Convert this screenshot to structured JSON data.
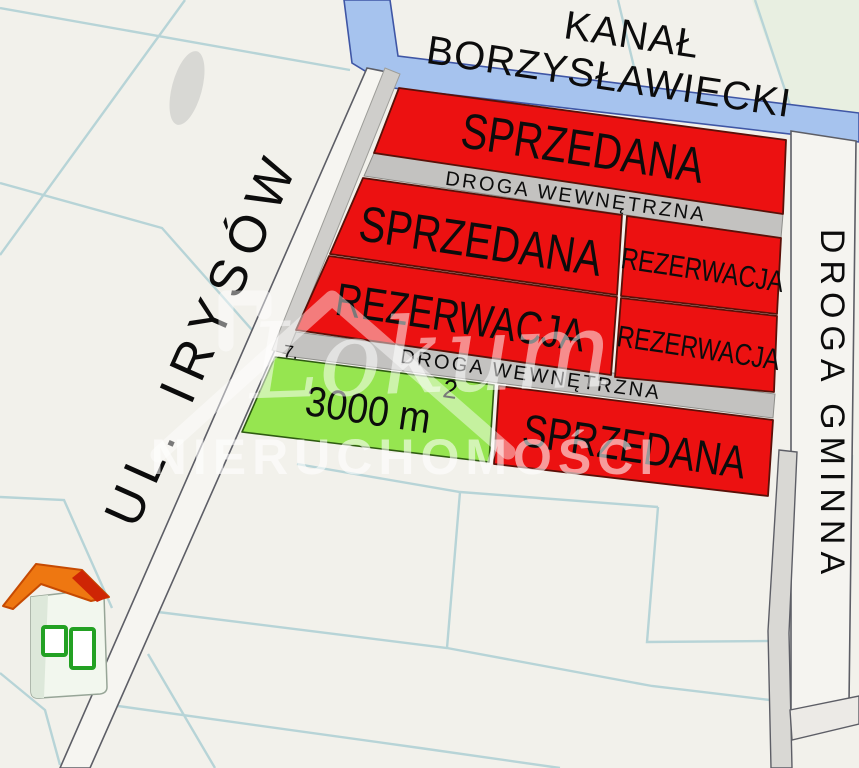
{
  "canal": {
    "line1": "KANAŁ",
    "line2": "BORZYSŁAWIECKI"
  },
  "streets": {
    "left_road": "UL. IRYSÓW",
    "right_road": "DROGA GMINNA",
    "internal_road_top": "DROGA WEWNĘTRZNA",
    "internal_road_bottom": "DROGA WEWNĘTRZNA"
  },
  "plots": {
    "row1": {
      "status": "SPRZEDANA"
    },
    "row2_left": {
      "status": "SPRZEDANA"
    },
    "row2_right": {
      "status": "REZERWACJA"
    },
    "row3_left": {
      "status": "REZERWACJA"
    },
    "row3_right": {
      "status": "REZERWACJA"
    },
    "row4_right": {
      "status": "SPRZEDANA"
    },
    "offered": {
      "number": "7.",
      "area": "3000 m",
      "area_exponent": "2"
    }
  },
  "watermark": {
    "brand_script": "Lokum",
    "brand_caps": "NIERUCHOMOŚCI"
  },
  "colors": {
    "background": "#f2f1eb",
    "field_green": "#e8efe1",
    "sold_reserved_red": "#ec1111",
    "offered_green": "#96e550",
    "internal_road_gray": "#c3c2c0",
    "canal_blue": "#a6c3ee",
    "parcel_line_teal": "#b7d4d7",
    "road_fill": "#f6f5f1"
  }
}
